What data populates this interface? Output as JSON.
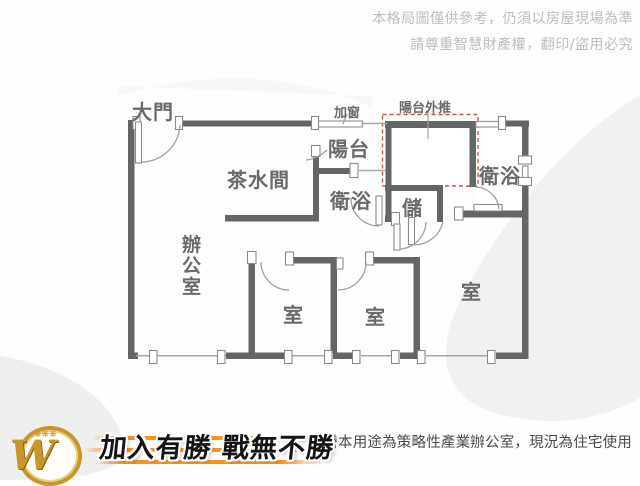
{
  "disclaimer": {
    "line1": "本格局圖僅供參考，仍須以房屋現場為準",
    "line2": "請尊重智慧財產權，翻印/盜用必究"
  },
  "plan": {
    "labels": {
      "main_door": "大門",
      "added_window": "加窗",
      "balcony_pushout": "陽台外推",
      "balcony": "陽台",
      "pantry": "茶水間",
      "bath_mid": "衛浴",
      "storage": "儲",
      "bath_right": "衛浴",
      "office": "辦公室",
      "room_left": "室",
      "room_mid": "室",
      "room_right": "室"
    },
    "colors": {
      "wall": "#656565",
      "window_line": "#a8a8a8",
      "door_arc": "#a0a0a0",
      "pushout_dashed": "#d4504f",
      "label_text": "#6a6a6a"
    }
  },
  "footer": {
    "logo_w": "W",
    "logo_deco": "❋❋❋",
    "slogan": "加入有勝 戰無不勝",
    "note": "★謄本用途為策略性產業辦公室，現況為住宅使用"
  }
}
